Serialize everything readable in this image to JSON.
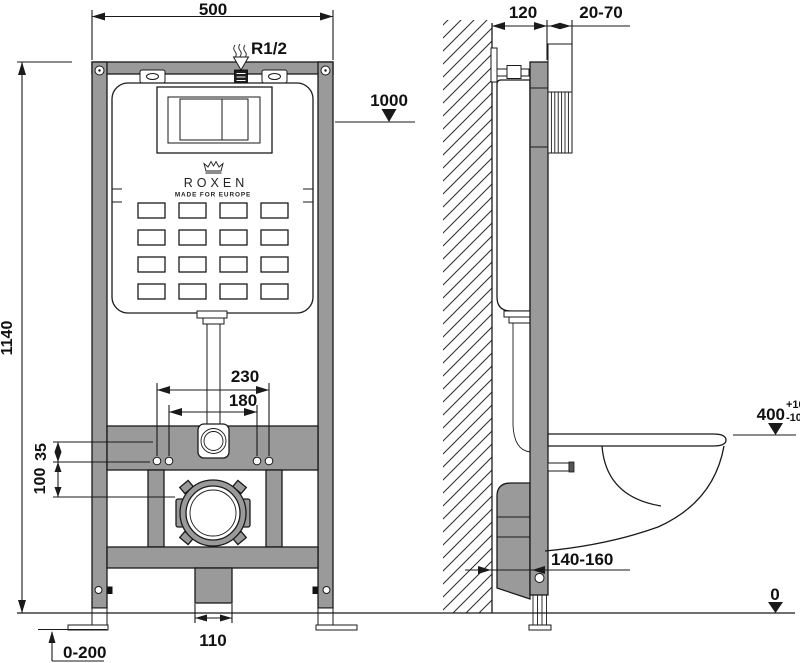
{
  "brand": {
    "name": "ROXEN",
    "tagline": "MADE FOR EUROPE"
  },
  "front_view": {
    "width_mm": "500",
    "inlet_thread": "R1/2",
    "flush_button_height": "1000",
    "frame_height": "1140",
    "fixing_spacing_outer": "230",
    "fixing_spacing_inner": "180",
    "offset_top": "35",
    "offset_bottom": "100",
    "drain_outlet_width": "110",
    "foot_adjust_range": "0-200"
  },
  "side_view": {
    "frame_depth": "120",
    "plate_adjust_range": "20-70",
    "seat_height": "400",
    "seat_tolerance_plus": "+10",
    "seat_tolerance_minus": "-10",
    "drain_offset_range": "140-160",
    "floor_level": "0"
  },
  "colors": {
    "frame_gray": "#9a9a9a",
    "line": "#1a1a1a",
    "background": "#ffffff"
  }
}
